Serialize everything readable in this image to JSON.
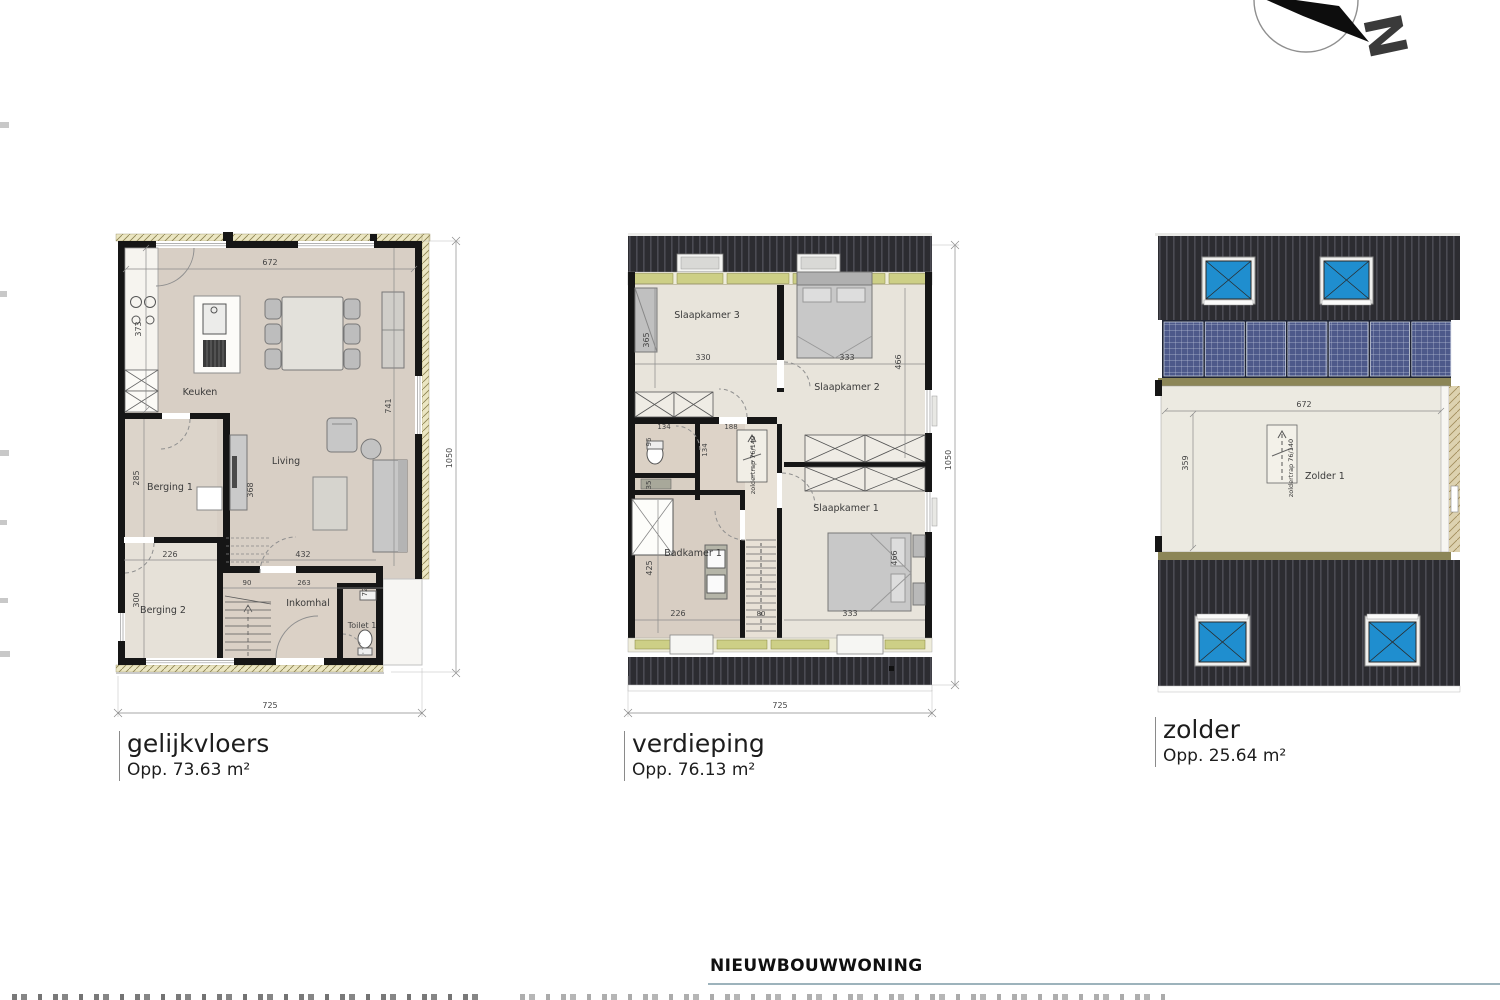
{
  "compass": {
    "north": "N"
  },
  "plans": {
    "gelijkvloers": {
      "title": "gelijkvloers",
      "area": "Opp. 73.63 m²",
      "rooms": {
        "keuken": "Keuken",
        "living": "Living",
        "berging1": "Berging 1",
        "berging2": "Berging 2",
        "inkomhal": "Inkomhal",
        "toilet1": "Toilet 1"
      },
      "dims": {
        "top_width": "672",
        "kitchen_wall": "373",
        "berging1_depth": "285",
        "berging2_width": "226",
        "berging2_depth": "300",
        "tv_wall": "368",
        "living_depth": "741",
        "living_width": "432",
        "hall_a": "90",
        "hall_b": "263",
        "toilet_depth": "72",
        "overall_width": "725",
        "overall_depth": "1050"
      }
    },
    "verdieping": {
      "title": "verdieping",
      "area": "Opp. 76.13 m²",
      "rooms": {
        "slaapkamer3": "Slaapkamer 3",
        "slaapkamer2": "Slaapkamer 2",
        "slaapkamer1": "Slaapkamer 1",
        "badkamer1": "Badkamer 1"
      },
      "stair_label": "zoldertrap 76/140",
      "dims": {
        "sk3_depth": "365",
        "sk3_width": "330",
        "sk2_width": "333",
        "sk2_depth": "466",
        "wc_width": "134",
        "wc_depth": "96",
        "hall_width": "134",
        "hall_b": "188",
        "niche": "35",
        "bad_depth": "425",
        "bad_width": "226",
        "stair_width": "80",
        "sk1_width": "333",
        "sk1_depth": "466",
        "overall_width": "725",
        "overall_depth": "1050"
      }
    },
    "zolder": {
      "title": "zolder",
      "area": "Opp. 25.64 m²",
      "rooms": {
        "zolder1": "Zolder 1"
      },
      "stair_label": "zoldertrap 76/140",
      "dims": {
        "width": "672",
        "depth": "359"
      }
    }
  },
  "footer": {
    "project_title": "NIEUWBOUWWONING"
  }
}
